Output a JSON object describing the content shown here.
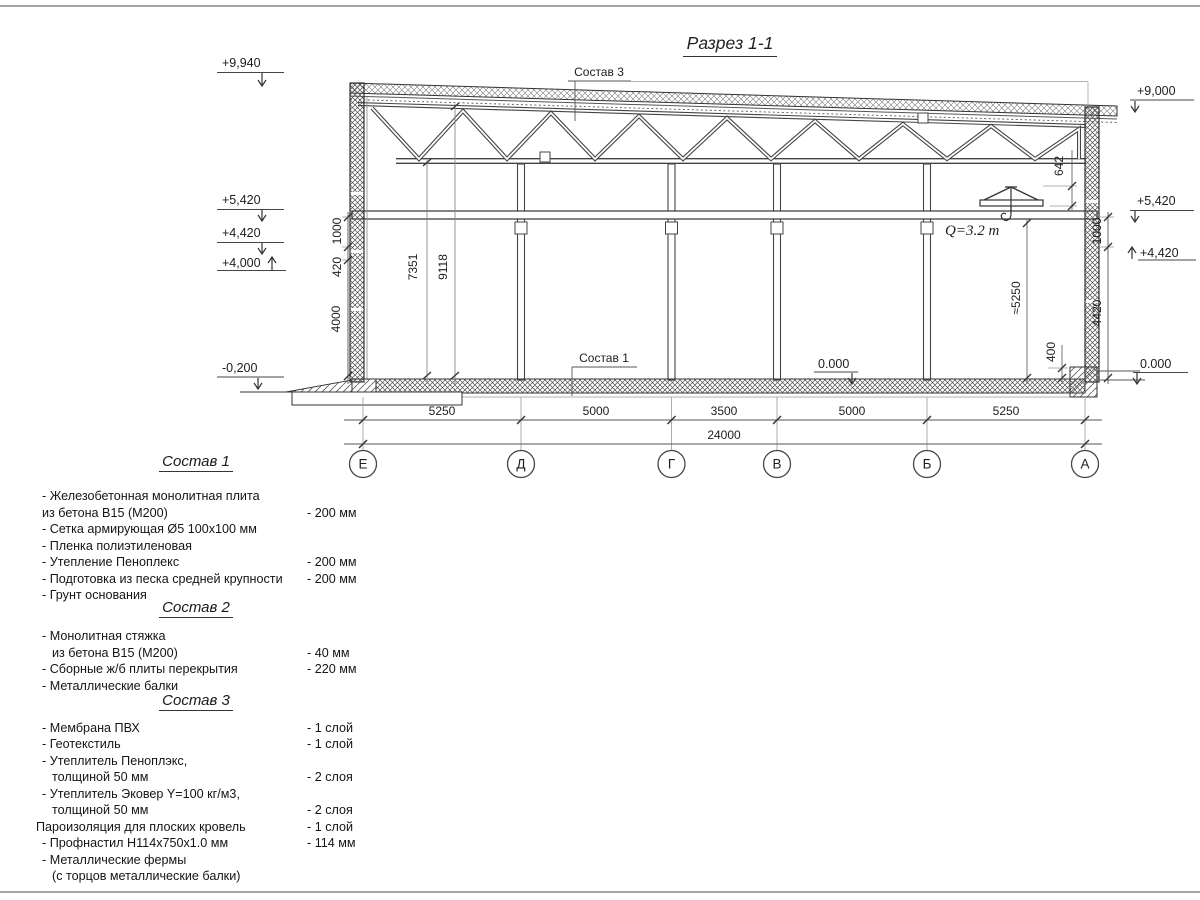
{
  "page": {
    "title": "Разрез 1-1"
  },
  "section": {
    "callouts": {
      "s1": "Состав 1",
      "s3": "Состав 3"
    },
    "crane": "Q=3.2 т",
    "elev": {
      "l1": "+9,940",
      "l2": "+5,420",
      "l3": "+4,420",
      "l4": "+4,000",
      "l5": "-0,200",
      "r1": "+9,000",
      "r2": "+5,420",
      "r3": "+4,420",
      "r4": "0.000",
      "floor0": "0.000"
    },
    "vdims": {
      "lw1000": "1000",
      "lw420": "420",
      "lw4000": "4000",
      "h7351": "7351",
      "h9118": "9118",
      "c642": "642",
      "hook5250": "≈5250",
      "rw1000": "1000",
      "rw4420": "4420",
      "rw400": "400"
    },
    "axes": [
      "Е",
      "Д",
      "Г",
      "В",
      "Б",
      "А"
    ],
    "spans": [
      "5250",
      "5000",
      "3500",
      "5000",
      "5250"
    ],
    "total": "24000"
  },
  "compositions": [
    {
      "heading": "Состав 1",
      "items": [
        {
          "t": "- Железобетонная  монолитная плита"
        },
        {
          "t": "из бетона  В15 (М200)",
          "v": "- 200 мм"
        },
        {
          "t": "- Сетка армирующая Ø5 100х100 мм"
        },
        {
          "t": "- Пленка полиэтиленовая"
        },
        {
          "t": "- Утепление Пеноплекс",
          "v": "- 200 мм"
        },
        {
          "t": "- Подготовка из песка средней  крупности",
          "v": "- 200 мм"
        },
        {
          "t": "- Грунт основания"
        }
      ]
    },
    {
      "heading": "Состав 2",
      "items": [
        {
          "t": "- Монолитная стяжка"
        },
        {
          "t": "из бетона В15 (М200)",
          "v": "- 40 мм"
        },
        {
          "t": "- Сборные ж/б плиты перекрытия",
          "v": "- 220 мм"
        },
        {
          "t": "- Металлические балки"
        }
      ]
    },
    {
      "heading": "Состав 3",
      "items": [
        {
          "t": "- Мембрана ПВХ",
          "v": "- 1 слой"
        },
        {
          "t": "- Геотекстиль",
          "v": "- 1 слой"
        },
        {
          "t": "- Утеплитель Пеноплэкс,"
        },
        {
          "t": "толщиной 50 мм",
          "v": "- 2 слоя"
        },
        {
          "t": "- Утеплитель Эковер Y=100 кг/м3,"
        },
        {
          "t": "толщиной 50 мм",
          "v": "- 2 слоя"
        },
        {
          "t": "Пароизоляция для плоских кровель",
          "v": "- 1 слой"
        },
        {
          "t": "- Профнастил Н114х750х1.0 мм",
          "v": "- 114 мм"
        },
        {
          "t": "- Металлические фермы"
        },
        {
          "t": "(с торцов металлические балки)"
        }
      ]
    }
  ]
}
